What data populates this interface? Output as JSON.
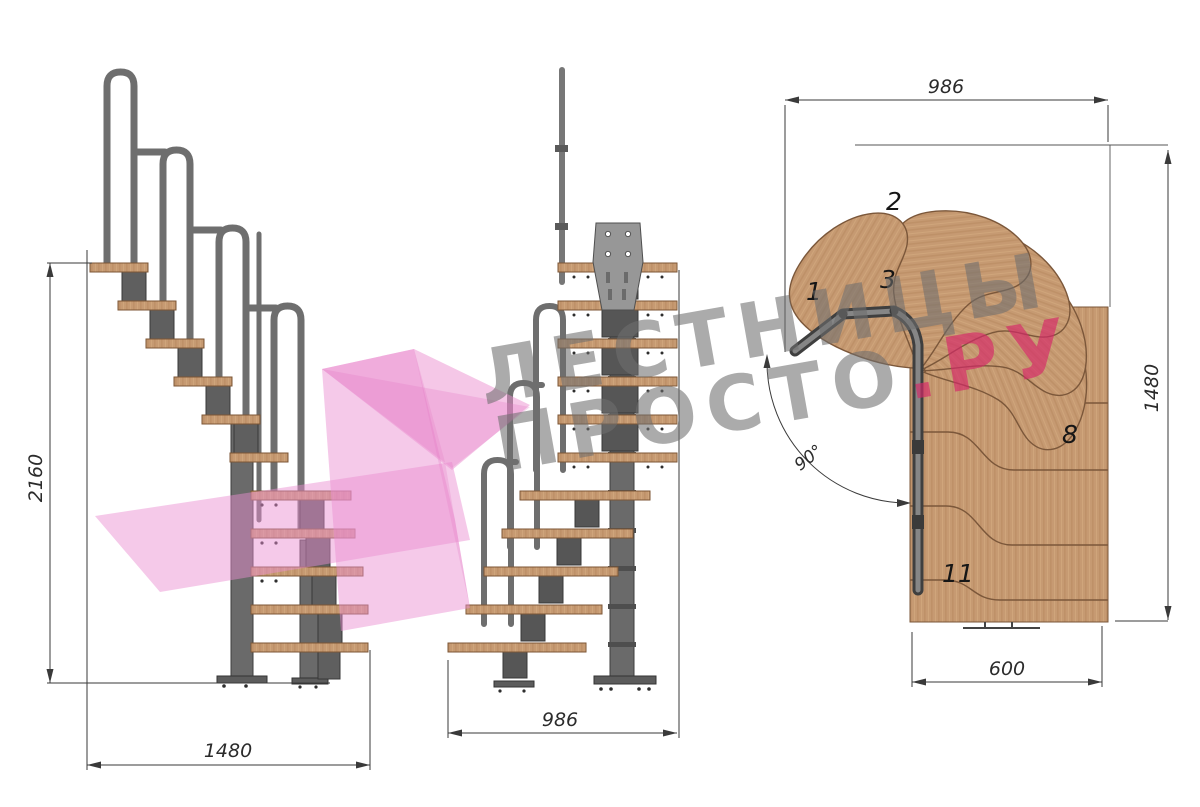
{
  "drawing": {
    "kind": "staircase-technical-drawing",
    "views": [
      "side-elevation",
      "front-elevation",
      "top-plan"
    ]
  },
  "dims": {
    "side_height": "2160",
    "side_width": "1480",
    "front_width": "986",
    "plan_width": "986",
    "plan_height": "1480",
    "plan_flight_width": "600",
    "plan_angle": "90°"
  },
  "plan": {
    "step_labels": [
      "1",
      "2",
      "3",
      "8",
      "11"
    ]
  },
  "watermark": {
    "line1": "ЛЕСТНИЦЫ",
    "line2_gray": "ПРОСТО",
    "line2_pink": ".РУ",
    "gray_hex": "#6e6e6e",
    "pink_hex": "#d62869",
    "ribbon_hex": "#eb8fd0"
  },
  "colors": {
    "wood": "#c69a72",
    "wood_edge": "#7c5636",
    "metal": "#707070",
    "metal_dark": "#4e4e4e",
    "dimension_line": "#3a3a3a"
  }
}
